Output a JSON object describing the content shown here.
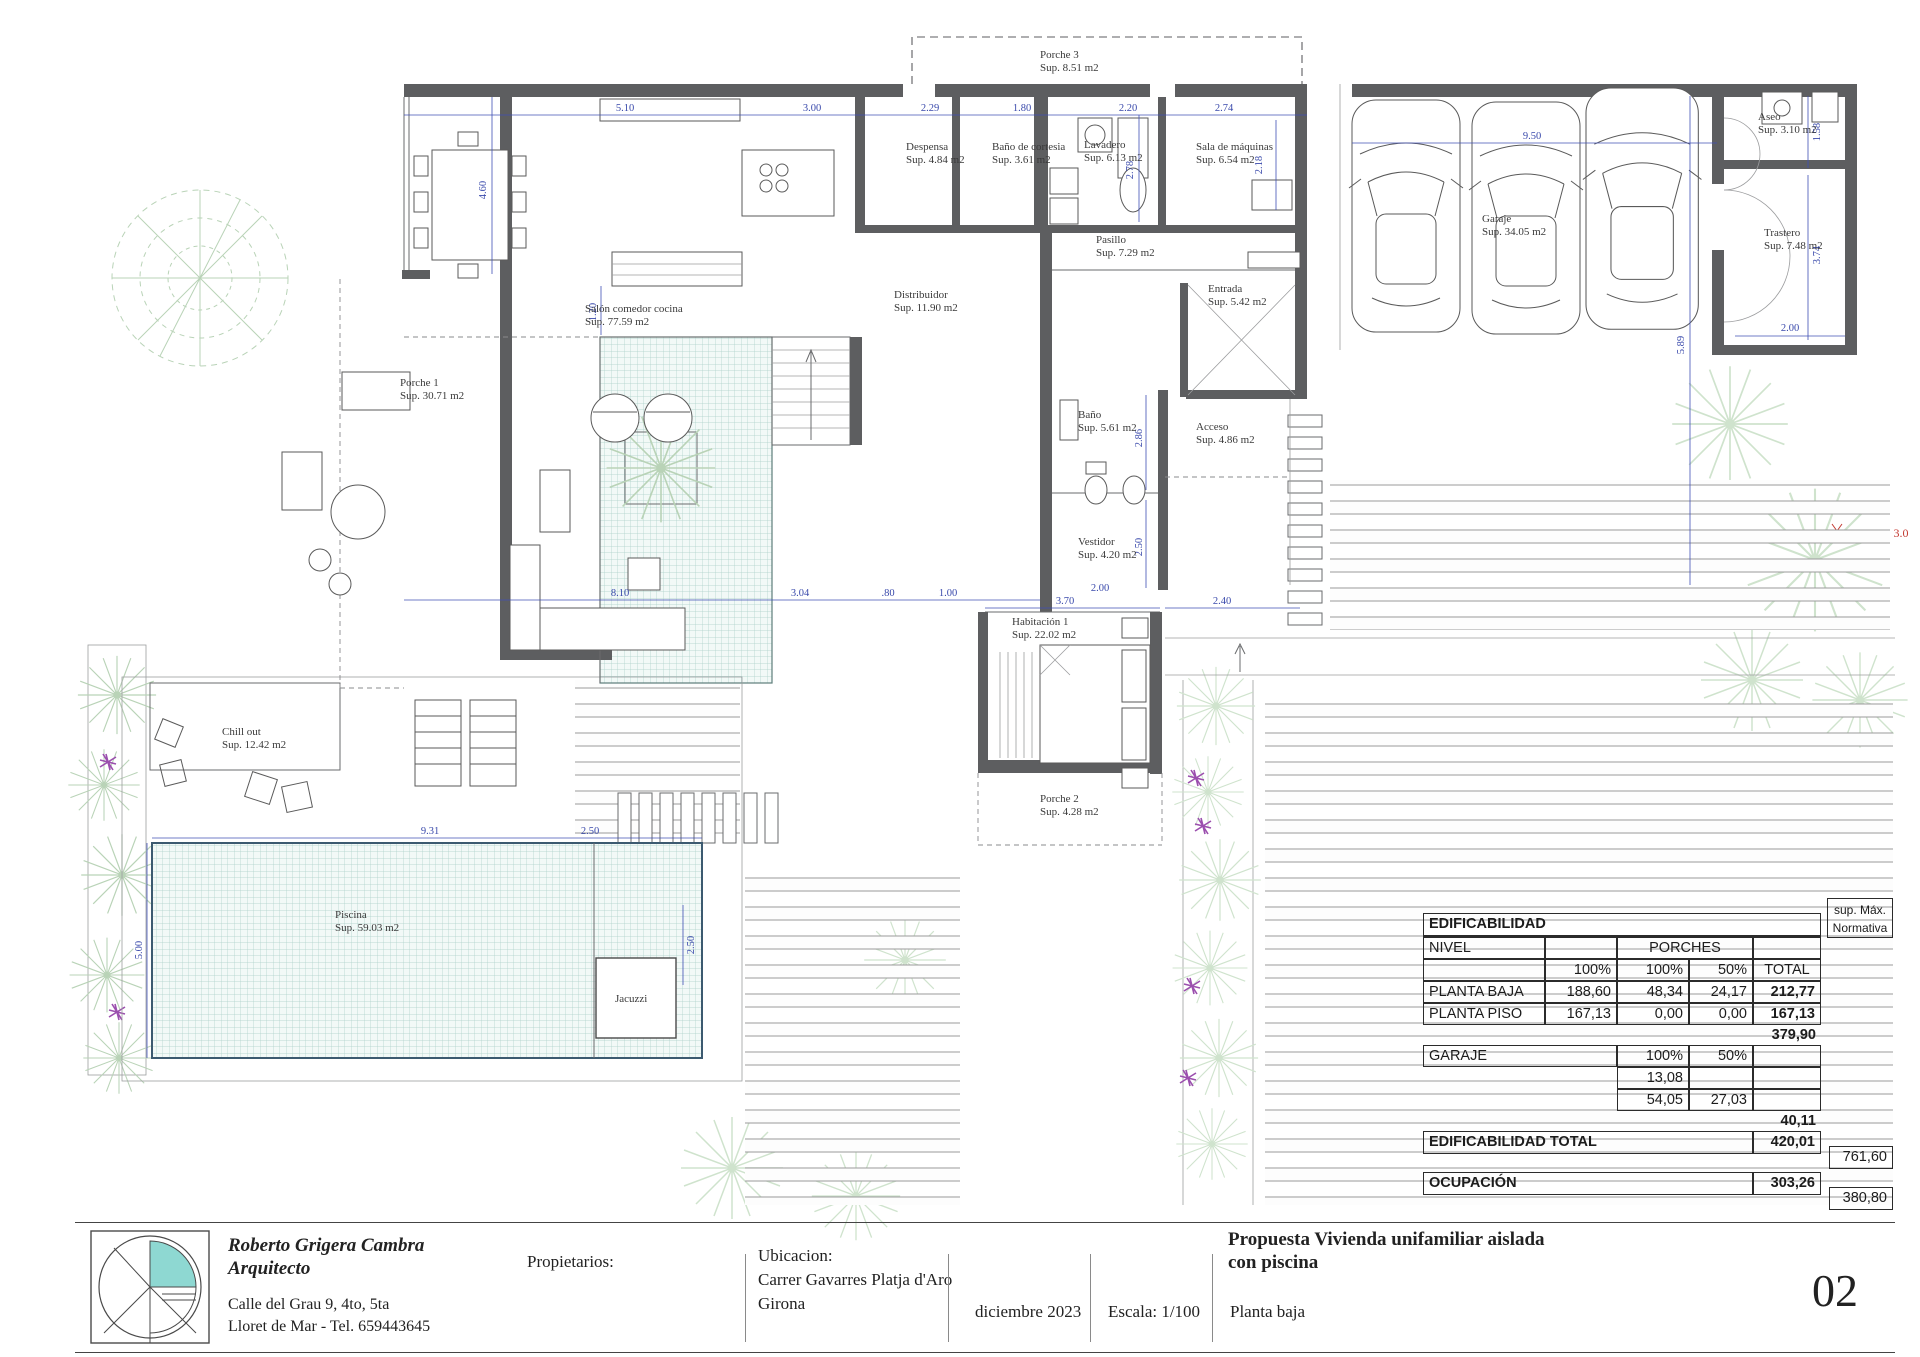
{
  "colors": {
    "wall": "#5d5e60",
    "dimension_blue": "#3949ab",
    "pool_teal_grid": "#aacfc8",
    "logo_teal": "#8ed8d2",
    "foliage_green": "#bed7bc",
    "flower_purple": "#9b4fae",
    "setback_red": "#c43b33"
  },
  "rooms": [
    {
      "name": "Porche 3",
      "sup": "Sup. 8.51 m2"
    },
    {
      "name": "Despensa",
      "sup": "Sup. 4.84 m2"
    },
    {
      "name": "Baño de cortesia",
      "sup": "Sup. 3.61 m2"
    },
    {
      "name": "Lavadero",
      "sup": "Sup. 6.13 m2"
    },
    {
      "name": "Sala de máquinas",
      "sup": "Sup. 6.54 m2"
    },
    {
      "name": "Pasillo",
      "sup": "Sup. 7.29 m2"
    },
    {
      "name": "Salón comedor cocina",
      "sup": "Sup. 77.59 m2"
    },
    {
      "name": "Distribuidor",
      "sup": "Sup. 11.90 m2"
    },
    {
      "name": "Entrada",
      "sup": "Sup. 5.42 m2"
    },
    {
      "name": "Porche 1",
      "sup": "Sup. 30.71 m2"
    },
    {
      "name": "Baño",
      "sup": "Sup. 5.61 m2"
    },
    {
      "name": "Acceso",
      "sup": "Sup. 4.86 m2"
    },
    {
      "name": "Vestidor",
      "sup": "Sup. 4.20 m2"
    },
    {
      "name": "Habitación 1",
      "sup": "Sup. 22.02 m2"
    },
    {
      "name": "Chill out",
      "sup": "Sup. 12.42 m2"
    },
    {
      "name": "Porche 2",
      "sup": "Sup. 4.28 m2"
    },
    {
      "name": "Piscina",
      "sup": "Sup. 59.03 m2"
    },
    {
      "name": "Jacuzzi",
      "sup": ""
    },
    {
      "name": "Aseo",
      "sup": "Sup. 3.10 m2"
    },
    {
      "name": "Garaje",
      "sup": "Sup. 34.05 m2"
    },
    {
      "name": "Trastero",
      "sup": "Sup. 7.48 m2"
    }
  ],
  "dims": [
    {
      "v": "5.10"
    },
    {
      "v": "3.00"
    },
    {
      "v": "2.29"
    },
    {
      "v": "1.80"
    },
    {
      "v": "2.20"
    },
    {
      "v": "2.74"
    },
    {
      "v": "9.50"
    },
    {
      "v": "5.89"
    },
    {
      "v": "2.18"
    },
    {
      "v": "2.78"
    },
    {
      "v": "1.58"
    },
    {
      "v": "3.74"
    },
    {
      "v": "2.00"
    },
    {
      "v": "2.86"
    },
    {
      "v": "2.50"
    },
    {
      "v": "2.00"
    },
    {
      "v": "3.70"
    },
    {
      "v": "2.40"
    },
    {
      "v": "8.10"
    },
    {
      "v": "3.04"
    },
    {
      "v": ".80"
    },
    {
      "v": "1.00"
    },
    {
      "v": "9.31"
    },
    {
      "v": "2.50"
    },
    {
      "v": "2.50"
    },
    {
      "v": "5.00"
    },
    {
      "v": "1.20"
    },
    {
      "v": "4.60"
    },
    {
      "v": "3.0"
    }
  ],
  "edificability_table": {
    "title": "EDIFICABILIDAD",
    "sup_max_line1": "sup.  Máx.",
    "sup_max_line2": "Normativa",
    "nivel_label": "NIVEL",
    "porches_label": "PORCHES",
    "col_100a": "100%",
    "col_100b": "100%",
    "col_50": "50%",
    "col_total": "TOTAL",
    "rows": [
      {
        "label": "PLANTA BAJA",
        "c1": "188,60",
        "c2": "48,34",
        "c3": "24,17",
        "total": "212,77"
      },
      {
        "label": "PLANTA PISO",
        "c1": "167,13",
        "c2": "0,00",
        "c3": "0,00",
        "total": "167,13"
      }
    ],
    "subtotal": "379,90",
    "garaje_label": "GARAJE",
    "garaje_c2": "100%",
    "garaje_c3": "50%",
    "garaje_row1_c2": "13,08",
    "garaje_row2_c2": "54,05",
    "garaje_row2_c3": "27,03",
    "garaje_subtotal": "40,11",
    "total_label": "EDIFICABILIDAD TOTAL",
    "total_value": "420,01",
    "total_max": "761,60",
    "ocupacion_label": "OCUPACIÓN",
    "ocupacion_value": "303,26",
    "ocupacion_max": "380,80"
  },
  "title_block": {
    "architect_name": "Roberto Grigera Cambra",
    "architect_role": "Arquitecto",
    "address_line1": "Calle del Grau 9, 4to, 5ta",
    "address_line2": "Lloret de Mar - Tel. 659443645",
    "owners_label": "Propietarios:",
    "location_label": "Ubicacion:",
    "location_line1": "Carrer Gavarres Platja d'Aro",
    "location_line2": "Girona",
    "date": "diciembre  2023",
    "scale": "Escala: 1/100",
    "plan_name": "Planta baja",
    "project_title_line1": "Propuesta Vivienda unifamiliar aislada",
    "project_title_line2": "con piscina",
    "sheet_number": "02"
  }
}
